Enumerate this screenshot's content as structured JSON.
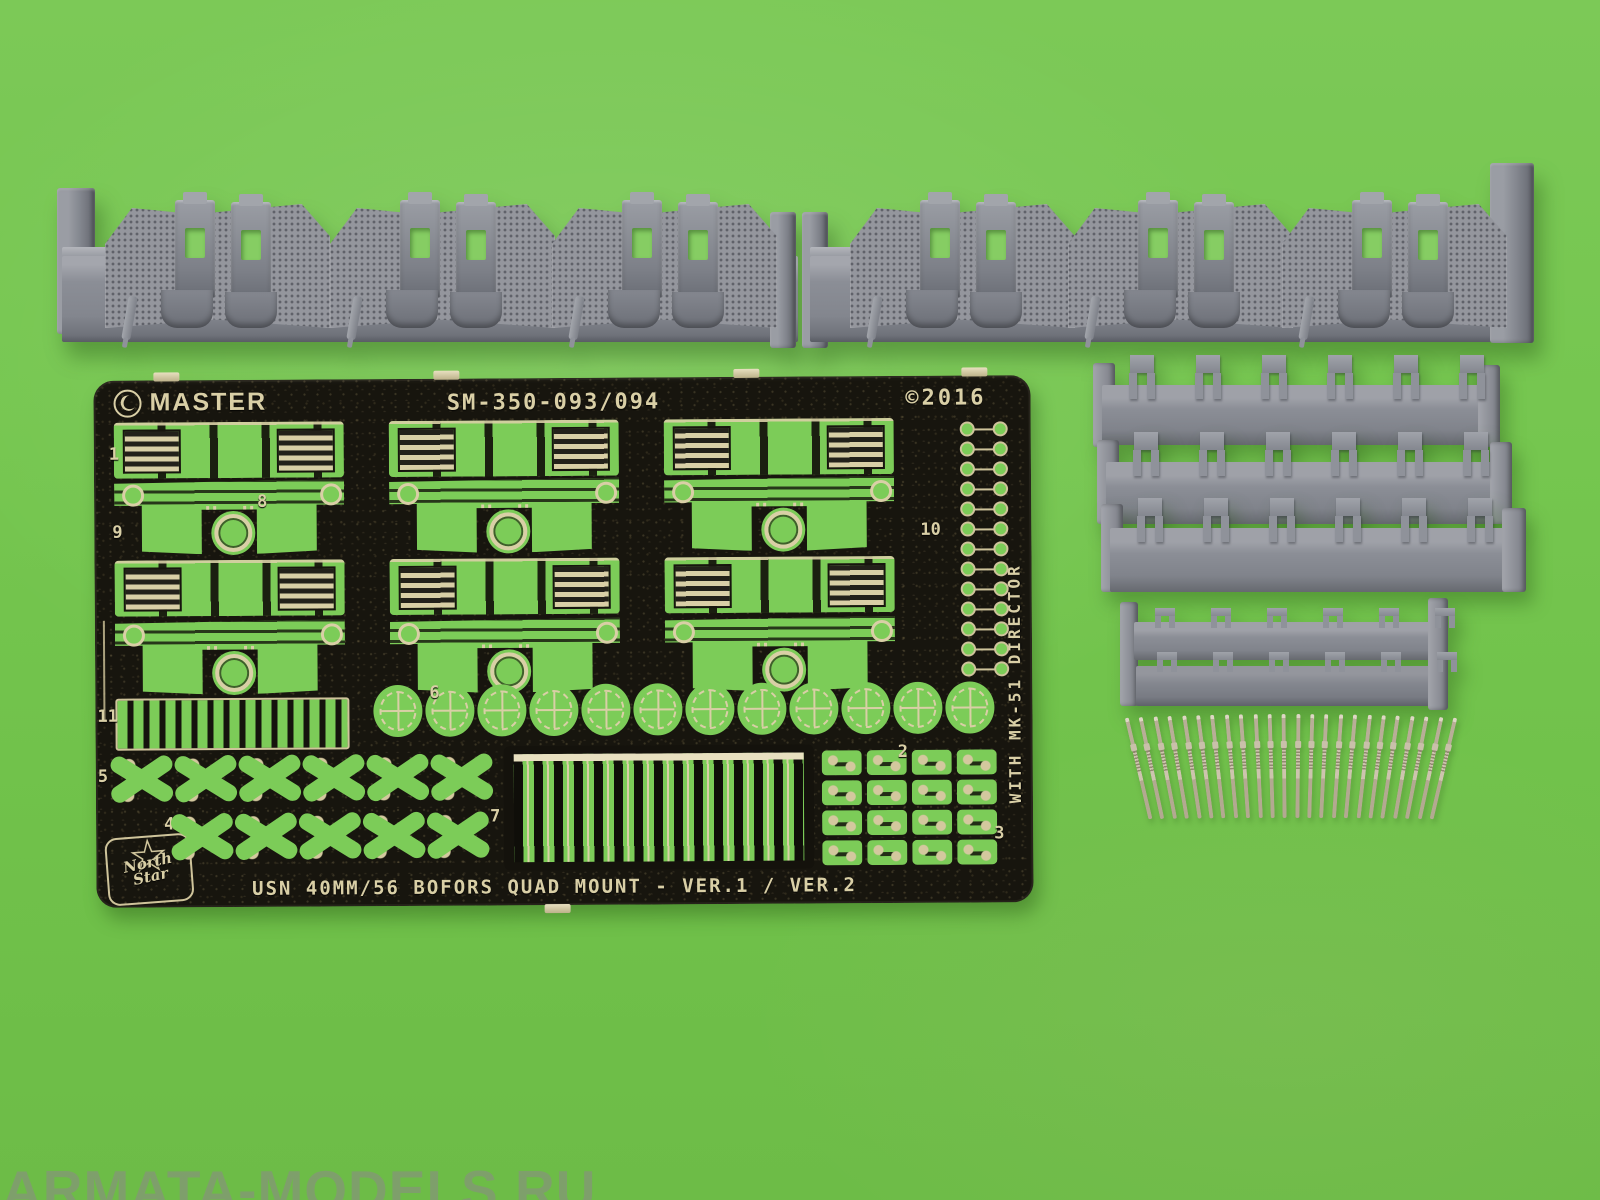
{
  "scene": {
    "description": "Model kit parts photographed on a green background",
    "background_color": "#75c64e"
  },
  "watermark": {
    "text": "ARMATA-MODELS.RU"
  },
  "fret": {
    "brand": "MASTER",
    "product_code": "SM-350-093/094",
    "copyright": "©2016",
    "vertical_note": "WITH MK-51 DIRECTOR",
    "footer_title": "USN 40MM/56 BOFORS QUAD MOUNT - VER.1 / VER.2",
    "maker_logo_line1": "North",
    "maker_logo_line2": "Star",
    "part_numbers": [
      "1",
      "9",
      "8",
      "10",
      "11",
      "5",
      "4",
      "6",
      "7",
      "2",
      "3"
    ],
    "colors": {
      "metal_base": "#17150e",
      "etch_metal": "#d9cfa6",
      "part_green": "#7ccc58"
    },
    "counts": {
      "rings": 12,
      "dumbbells": 13,
      "x_parts_row5": 6,
      "x_parts_row4": 5,
      "grid2_parts": 8,
      "grid3_parts": 8
    }
  },
  "resin": {
    "color": "#8b8e96",
    "top_bars": {
      "bars": 2,
      "assemblies_per_bar": 3
    },
    "stack": {
      "bars": 3,
      "parts_per_bar": 6
    },
    "tray": {
      "rails": 2,
      "parts_per_rail": 6
    }
  },
  "barrels": {
    "count": 24,
    "color": "#c7bda7"
  }
}
